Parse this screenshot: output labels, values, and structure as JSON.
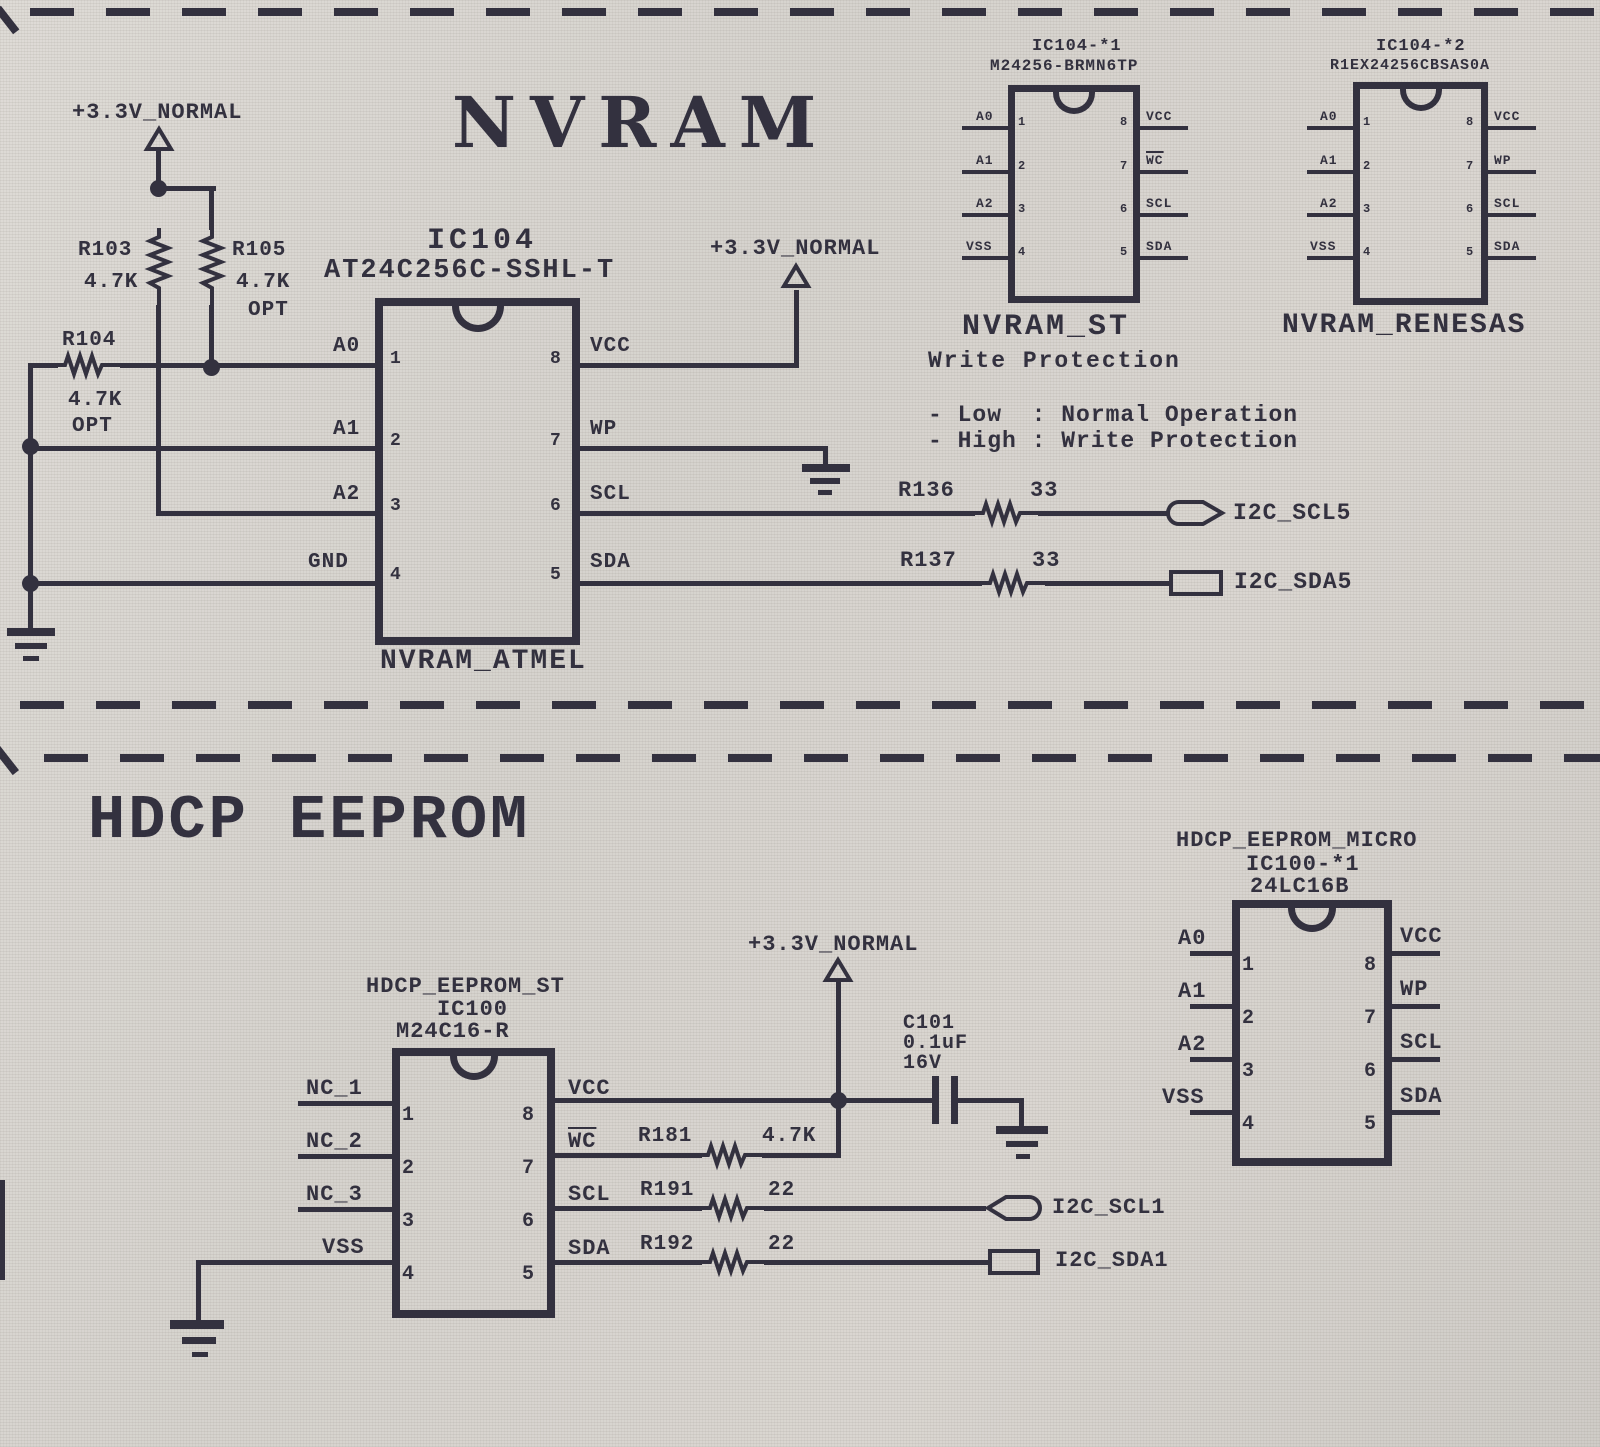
{
  "pinnum": {
    "n1": "1",
    "n2": "2",
    "n3": "3",
    "n4": "4",
    "n5": "5",
    "n6": "6",
    "n7": "7",
    "n8": "8"
  },
  "nvram": {
    "title": "NVRAM",
    "pwr_left": "+3.3V_NORMAL",
    "pwr_vcc": "+3.3V_NORMAL",
    "r103": {
      "ref": "R103",
      "val": "4.7K"
    },
    "r104": {
      "ref": "R104",
      "val": "4.7K",
      "opt": "OPT"
    },
    "r105": {
      "ref": "R105",
      "val": "4.7K",
      "opt": "OPT"
    },
    "r136": {
      "ref": "R136",
      "val": "33"
    },
    "r137": {
      "ref": "R137",
      "val": "33"
    },
    "net_scl5": "I2C_SCL5",
    "net_sda5": "I2C_SDA5",
    "wp_note": {
      "heading": "Write Protection",
      "low": "- Low  : Normal Operation",
      "high": "- High : Write Protection"
    },
    "ic_main": {
      "ref": "IC104",
      "part": "AT24C256C-SSHL-T",
      "caption": "NVRAM_ATMEL",
      "p1": "A0",
      "p2": "A1",
      "p3": "A2",
      "p4": "GND",
      "p5": "SDA",
      "p6": "SCL",
      "p7": "WP",
      "p8": "VCC"
    },
    "ic_st": {
      "ref": "IC104-*1",
      "part": "M24256-BRMN6TP",
      "caption": "NVRAM_ST",
      "p1": "A0",
      "p2": "A1",
      "p3": "A2",
      "p4": "VSS",
      "p5": "SDA",
      "p6": "SCL",
      "p7": "WC",
      "p8": "VCC"
    },
    "ic_renesas": {
      "ref": "IC104-*2",
      "part": "R1EX24256CBSAS0A",
      "caption": "NVRAM_RENESAS",
      "p1": "A0",
      "p2": "A1",
      "p3": "A2",
      "p4": "VSS",
      "p5": "SDA",
      "p6": "SCL",
      "p7": "WP",
      "p8": "VCC"
    }
  },
  "hdcp": {
    "title": "HDCP EEPROM",
    "pwr": "+3.3V_NORMAL",
    "c101": {
      "ref": "C101",
      "val": "0.1uF",
      "volt": "16V"
    },
    "r181": {
      "ref": "R181",
      "val": "4.7K"
    },
    "r191": {
      "ref": "R191",
      "val": "22"
    },
    "r192": {
      "ref": "R192",
      "val": "22"
    },
    "net_scl1": "I2C_SCL1",
    "net_sda1": "I2C_SDA1",
    "ic_st": {
      "name": "HDCP_EEPROM_ST",
      "ref": "IC100",
      "part": "M24C16-R",
      "p1": "NC_1",
      "p2": "NC_2",
      "p3": "NC_3",
      "p4": "VSS",
      "p5": "SDA",
      "p6": "SCL",
      "p7": "WC",
      "p8": "VCC"
    },
    "ic_micro": {
      "name": "HDCP_EEPROM_MICRO",
      "ref": "IC100-*1",
      "part": "24LC16B",
      "p1": "A0",
      "p2": "A1",
      "p3": "A2",
      "p4": "VSS",
      "p5": "SDA",
      "p6": "SCL",
      "p7": "WP",
      "p8": "VCC"
    }
  }
}
